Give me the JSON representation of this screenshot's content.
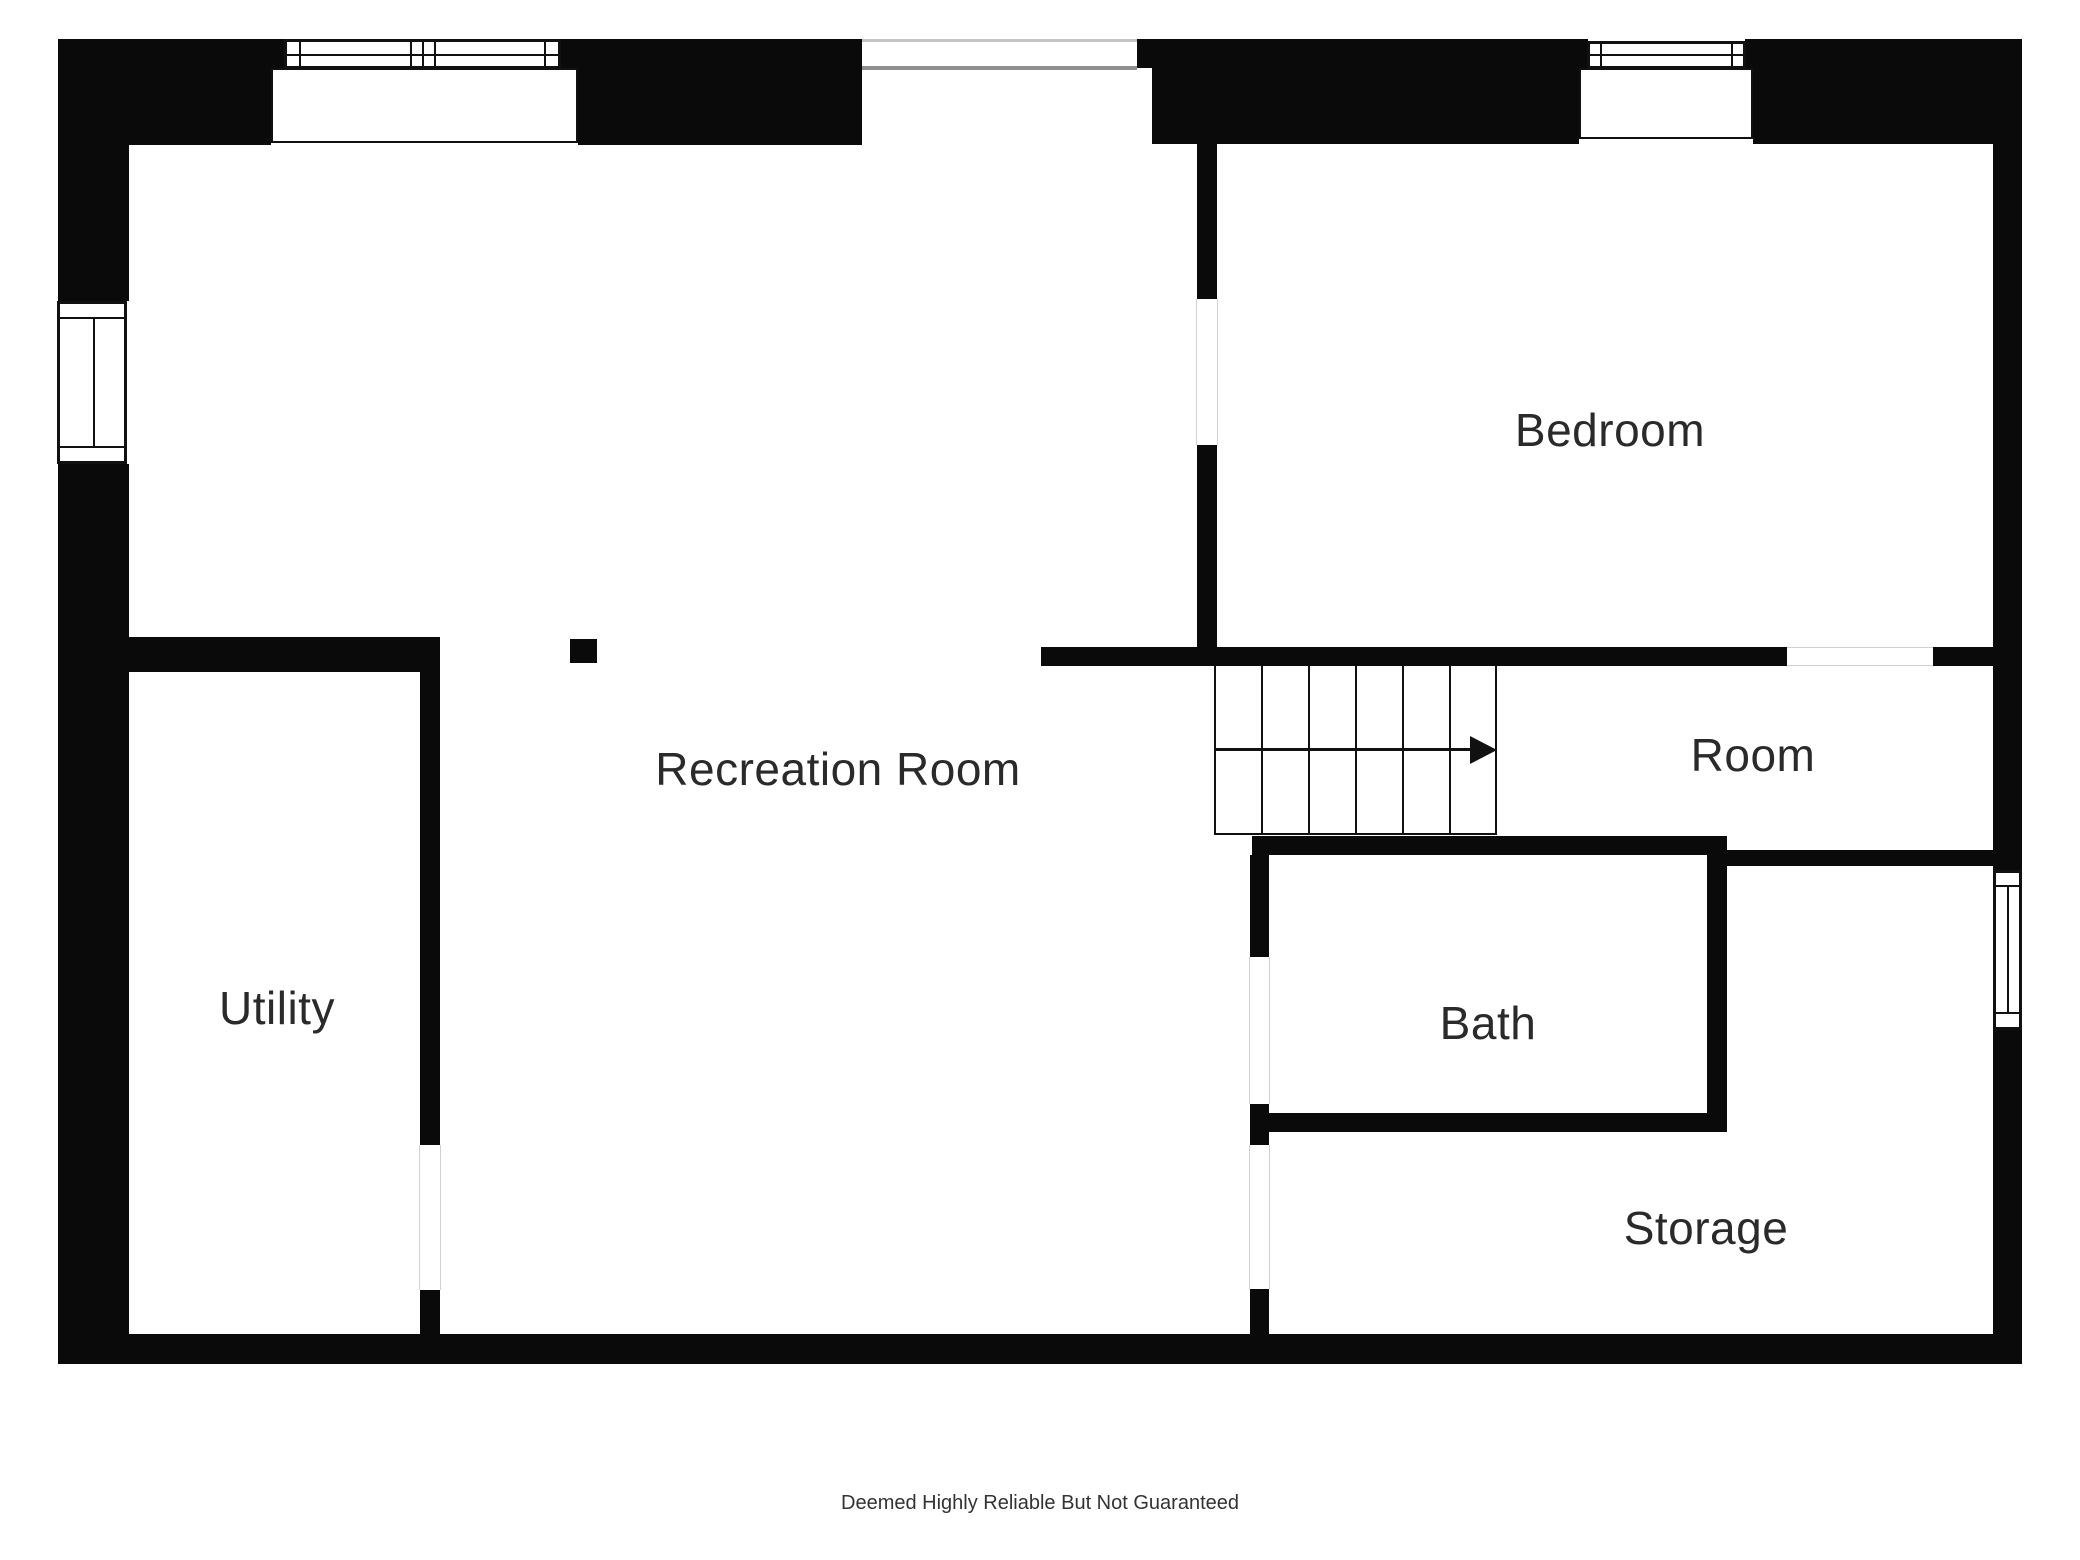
{
  "page": {
    "title": "Basement floor plan",
    "disclaimer": "Deemed Highly Reliable But Not Guaranteed"
  },
  "floor_plan": {
    "rooms": [
      {
        "id": "bedroom",
        "label": "Bedroom"
      },
      {
        "id": "room",
        "label": "Room"
      },
      {
        "id": "recreation_room",
        "label": "Recreation Room"
      },
      {
        "id": "utility",
        "label": "Utility"
      },
      {
        "id": "bath",
        "label": "Bath"
      },
      {
        "id": "storage",
        "label": "Storage"
      }
    ],
    "features": {
      "stair_tread_count": 6,
      "stair_direction_icon": "right-arrow",
      "window_count": 4,
      "door_opening_count": 5
    },
    "colors": {
      "wall": "#0a0a0a",
      "background": "#ffffff",
      "label_text": "#2a2a2a",
      "opening_line_light": "#c4c4c4",
      "opening_line_dark": "#8f8f8f",
      "door_gap_line": "#d0d0d0"
    }
  }
}
